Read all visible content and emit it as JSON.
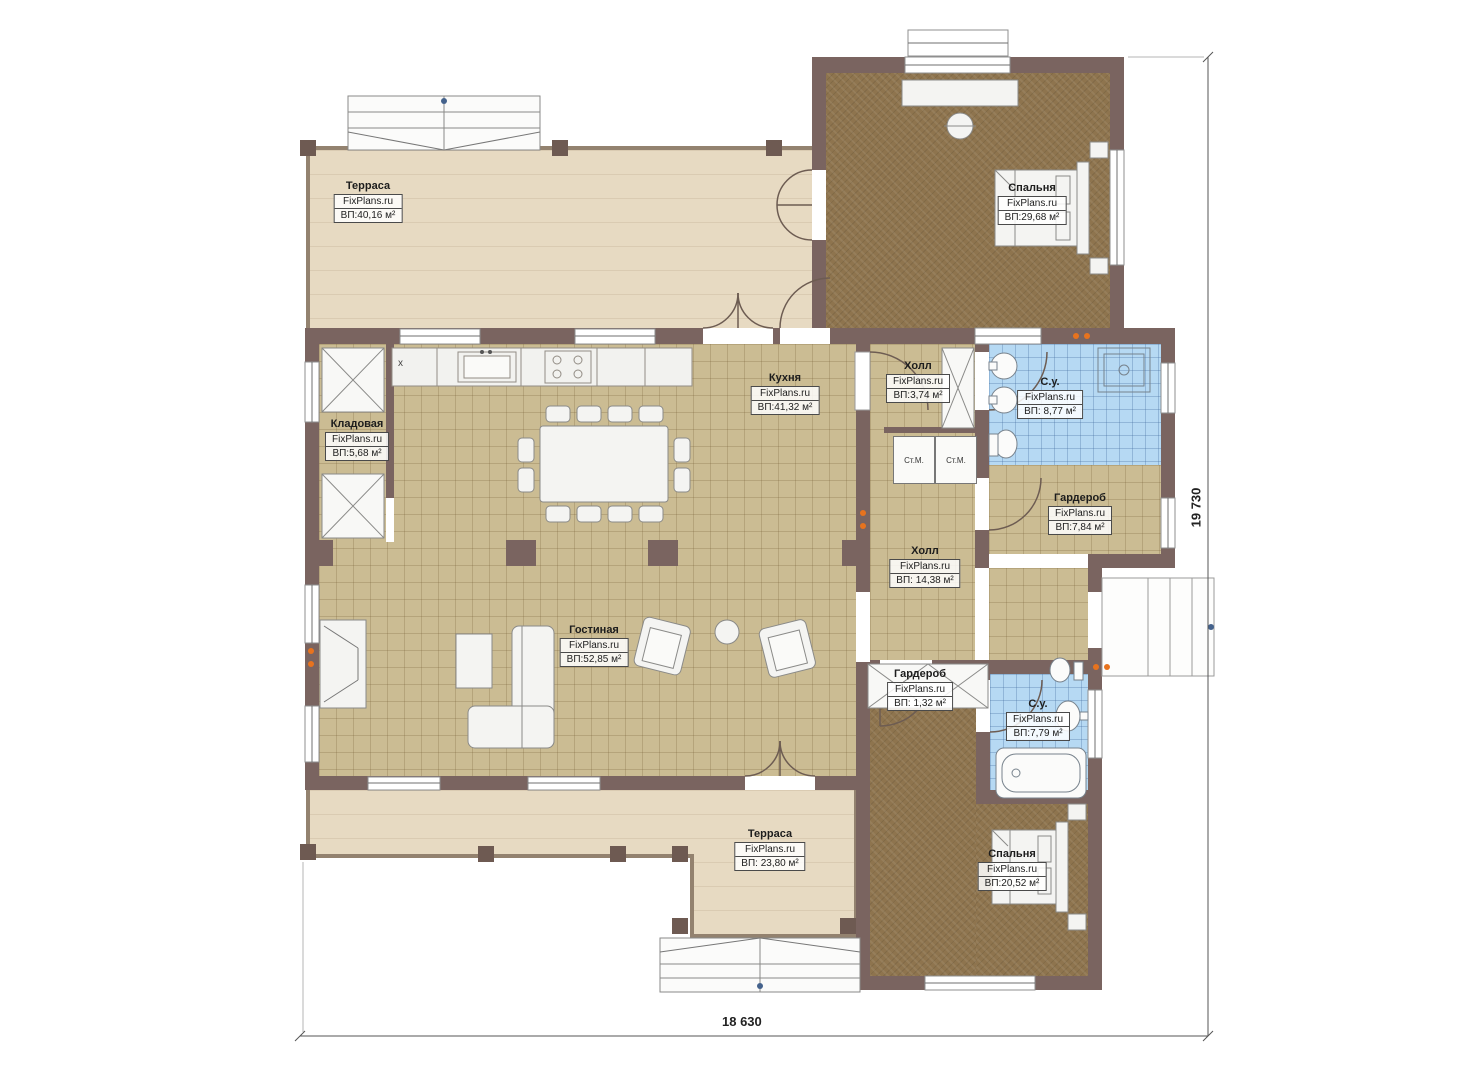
{
  "plan": {
    "watermark": "FixPlans.ru",
    "kitchen_marker": "x",
    "dimensions": {
      "width_label": "18 630",
      "height_label": "19 730"
    },
    "appliances": {
      "washer1": "Ст.М.",
      "washer2": "Ст.М."
    },
    "colors": {
      "wall": "#7a6460",
      "tile_floor": "#cbbc93",
      "carpet": "#8e744e",
      "bathroom_tile": "#b6d9f3",
      "terrace": "#e7dac2",
      "radiator": "#e8731e",
      "fixture": "#f4f4f2"
    },
    "rooms": [
      {
        "id": "terrace-top",
        "name": "Терраса",
        "area": "ВП:40,16 м²"
      },
      {
        "id": "bedroom-top",
        "name": "Спальня",
        "area": "ВП:29,68 м²"
      },
      {
        "id": "kitchen",
        "name": "Кухня",
        "area": "ВП:41,32 м²"
      },
      {
        "id": "pantry",
        "name": "Кладовая",
        "area": "ВП:5,68 м²"
      },
      {
        "id": "hall-small",
        "name": "Холл",
        "area": "ВП:3,74 м²"
      },
      {
        "id": "bathroom-top",
        "name": "С.у.",
        "area": "ВП: 8,77 м²"
      },
      {
        "id": "wardrobe-top",
        "name": "Гардероб",
        "area": "ВП:7,84 м²"
      },
      {
        "id": "hall-main",
        "name": "Холл",
        "area": "ВП: 14,38 м²"
      },
      {
        "id": "living",
        "name": "Гостиная",
        "area": "ВП:52,85 м²"
      },
      {
        "id": "wardrobe-small",
        "name": "Гардероб",
        "area": "ВП: 1,32 м²"
      },
      {
        "id": "bathroom-bottom",
        "name": "С.у.",
        "area": "ВП:7,79 м²"
      },
      {
        "id": "bedroom-bottom",
        "name": "Спальня",
        "area": "ВП:20,52 м²"
      },
      {
        "id": "terrace-bottom",
        "name": "Терраса",
        "area": "ВП: 23,80 м²"
      }
    ]
  }
}
